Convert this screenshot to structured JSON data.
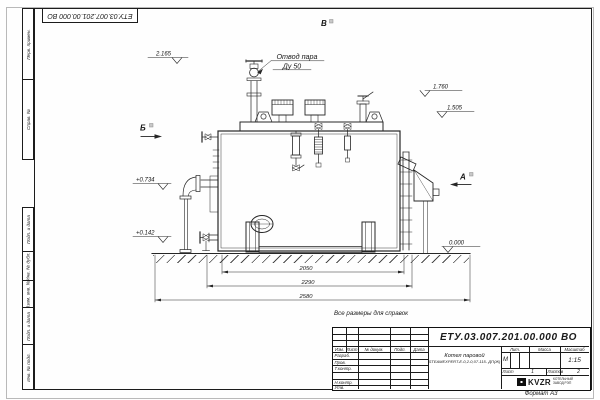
{
  "sheet": {
    "doc_number_rotated": "ЕТУ.03.007.201.00.000  ВО",
    "reference_note": "Все размеры для справок",
    "format_note": "Формат  А3",
    "margin_boxes": [
      "Перв. примен.",
      "Справ. №",
      "Подп. и дата",
      "Инв. № дубл.",
      "Взам. инв. №",
      "Подп. и дата",
      "Инв. № подл."
    ]
  },
  "drawing": {
    "callout_line1": "Отвод пара",
    "callout_line2": "Ду 50",
    "view_top": "В",
    "view_left": "Б",
    "view_right": "А",
    "elev_top": "2.165",
    "elev_1760": "1.760",
    "elev_1505": "1.505",
    "elev_0734": "+0.734",
    "elev_0142": "+0.142",
    "elev_zero": "0.000",
    "dim_inner": "2050",
    "dim_mid": "2290",
    "dim_outer": "2580"
  },
  "title_block": {
    "doc_number": "ЕТУ.03.007.201.00.000  ВО",
    "product_name": "Котел паровой",
    "product_model": "STEAMEXPERT-Е-0,2-0,07-115- ДП(Ж)",
    "col_izm": "Изм.",
    "col_list": "Лист",
    "col_ndokum": "№ докум.",
    "col_podp": "Подп.",
    "col_data": "Дата",
    "role_razrab": "Разраб.",
    "role_prov": "Пров.",
    "role_tkontr": "Т.контр.",
    "role_nkontr": "Н.контр.",
    "role_utv": "Утв.",
    "lit_label": "Лит.",
    "lit_value": "М",
    "mass_label": "Масса",
    "scale_label": "Масштаб",
    "scale_value": "1:15",
    "sheet_label": "Лист",
    "sheet_value": "1",
    "sheets_label": "Листов",
    "sheets_value": "2",
    "company_logo": "KVZR",
    "company_line1": "КОТЕЛЬНЫЙ",
    "company_line2": "ЗАВОД РЭП"
  }
}
